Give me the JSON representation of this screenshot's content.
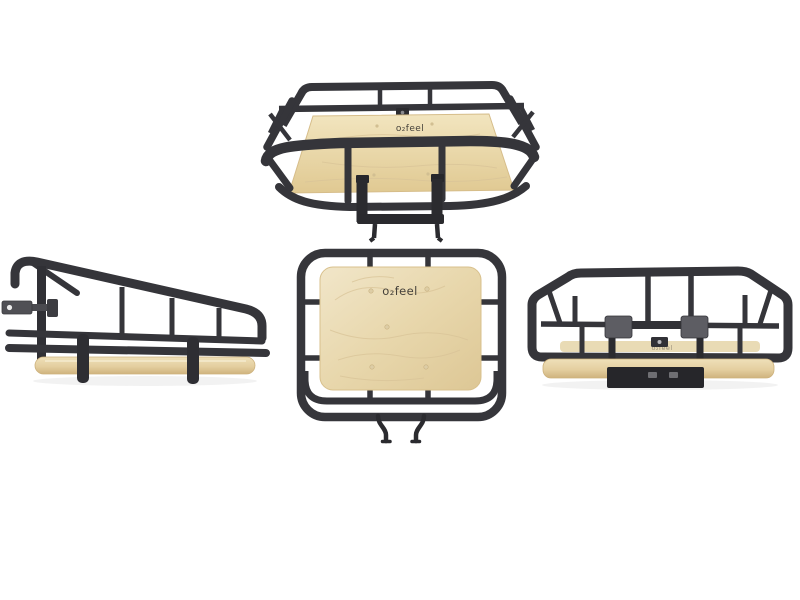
{
  "page": {
    "type": "product-photo-grid",
    "background": "#ffffff",
    "subject": "Bicycle front cargo basket with black metal tube frame and wooden (birch plywood) base, photographed from four angles on a white background"
  },
  "brand": {
    "logo": "o₂feel"
  },
  "views": [
    {
      "id": "front-perspective",
      "description": "Front three-quarter view from above, wooden floor with logo, front bumper tube and rack-mount bracket"
    },
    {
      "id": "side-profile",
      "description": "Side profile view, sloped top rail, mounting tab, wooden base edge-on"
    },
    {
      "id": "top-down",
      "description": "Top-down view, rounded tube frame around wooden base with logo, two mounting hooks below"
    },
    {
      "id": "rear",
      "description": "Rear view with two grey mounting clamps and lower bracket plate"
    }
  ],
  "colors": {
    "frame": "#35353a",
    "frame_dark": "#27272b",
    "bracket_gray": "#5d5d62",
    "wood_light": "#f1e6c9",
    "wood_mid": "#e6d4a6",
    "wood_shade": "#d7bf8f",
    "logo_text": "#45413a",
    "background": "#ffffff"
  }
}
